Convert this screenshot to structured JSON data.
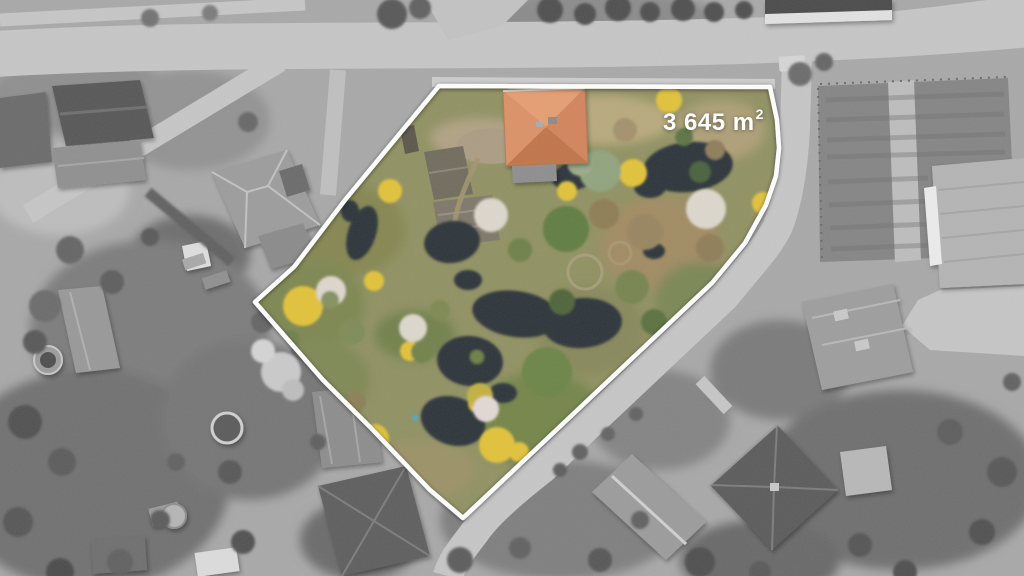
{
  "area_overlay": {
    "text": "3 645 m",
    "exponent": "2"
  },
  "colors": {
    "boundary": "#ffffff",
    "label": "#ffffff",
    "roof": "#d2835a",
    "pond": "#2c3137",
    "yellow_foliage": "#e2c238",
    "road": "#c6c6c6"
  }
}
